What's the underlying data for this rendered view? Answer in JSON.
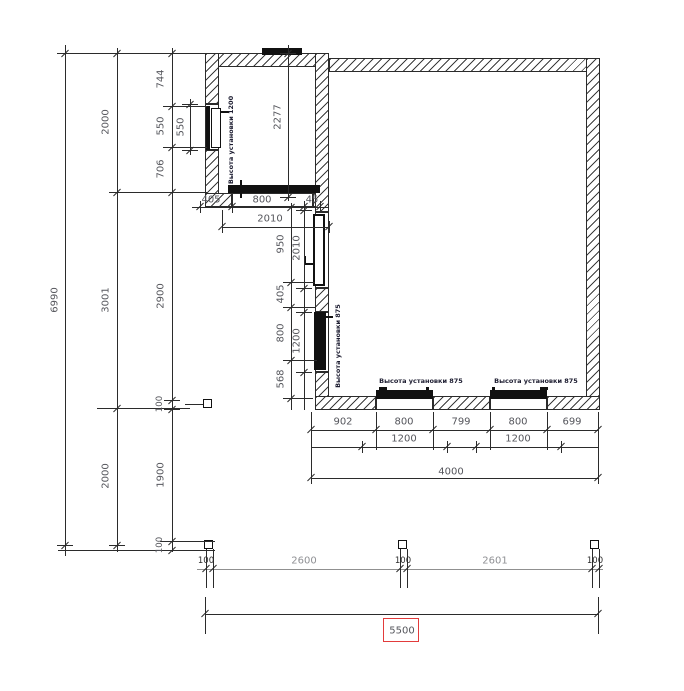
{
  "meta": {
    "type": "architectural-floor-plan",
    "units": "mm"
  },
  "colors": {
    "line": "#2b2b2b",
    "dim_text": "#55565c",
    "dim_text_light": "#8f9094",
    "selection_red": "#e23b3b",
    "background": "#ffffff"
  },
  "dims": {
    "v_total": "6990",
    "v_col2": [
      "2000",
      "3001",
      "2000"
    ],
    "v_col3": [
      "744",
      "550",
      "706",
      "2900",
      "100",
      "1900",
      "100"
    ],
    "v_rad": "550",
    "v_room": "2277",
    "v_wall": [
      "950",
      "405",
      "800",
      "568"
    ],
    "v_win": [
      "2010",
      "1200"
    ],
    "h_top": [
      "405",
      "800",
      "45"
    ],
    "h_top_span": "2010",
    "h_chain": [
      "902",
      "800",
      "799",
      "800",
      "699"
    ],
    "h_win": [
      "1200",
      "1200"
    ],
    "h_span": "4000",
    "h_grid": [
      "100",
      "2600",
      "100",
      "2601",
      "100"
    ],
    "h_total": "5500"
  },
  "annotations": {
    "rad_small": "Высота установки 1200",
    "rad_left": "Высота установки 875",
    "rad_bottom_1": "Высота установки 875",
    "rad_bottom_2": "Высота установки 875"
  }
}
